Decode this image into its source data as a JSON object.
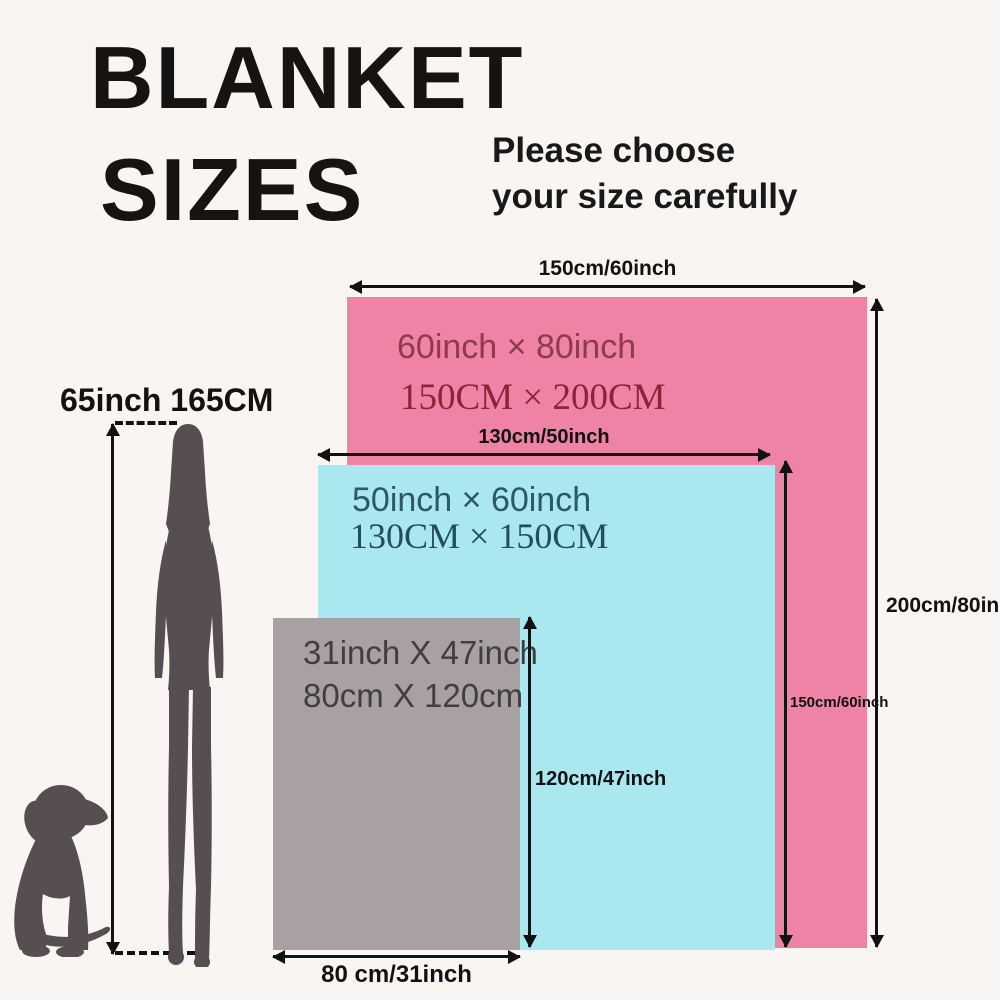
{
  "title": {
    "line1": "BLANKET",
    "line2": "SIZES"
  },
  "subtitle": {
    "line1": "Please choose",
    "line2": "your size carefully"
  },
  "person": {
    "height_label": "65inch 165CM",
    "figures": [
      "woman-silhouette",
      "dog-silhouette"
    ]
  },
  "blankets": {
    "large": {
      "name": "queen blanket",
      "inch_label": "60inch × 80inch",
      "cm_label": "150CM × 200CM",
      "width_label": "150cm/60inch",
      "height_label": "200cm/80inch",
      "color": "#ee83a5"
    },
    "medium": {
      "name": "throw blanket",
      "inch_label": "50inch × 60inch",
      "cm_label": "130CM × 150CM",
      "width_label": "130cm/50inch",
      "height_label": "150cm/60inch",
      "color": "#abe7ee"
    },
    "small": {
      "name": "small blanket",
      "inch_label": "31inch X 47inch",
      "cm_label": "80cm X 120cm",
      "width_label": "80 cm/31inch",
      "height_label": "120cm/47inch",
      "color": "#a8a0a1"
    }
  },
  "colors": {
    "background": "#f8f5f2",
    "arrow": "#121212",
    "silhouette": "#564e50",
    "large_text_inch": "#8f3a50",
    "large_text_cm": "#8d2338",
    "medium_text": "#2b5966",
    "small_text": "#413e3f"
  }
}
